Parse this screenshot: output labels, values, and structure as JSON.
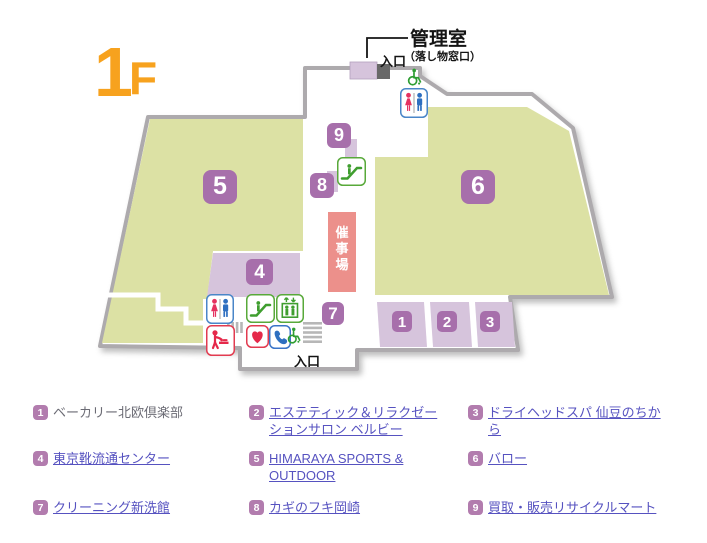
{
  "floor_label": {
    "number": "1",
    "suffix": "F"
  },
  "map": {
    "admin_room_label": "管理室",
    "admin_room_sub": "（落し物窓口）",
    "entrance_top": "入口",
    "entrance_bottom": "入口",
    "event_space": "催事場",
    "event_space_chars": [
      "催",
      "事",
      "場"
    ],
    "badges": {
      "b1": "1",
      "b2": "2",
      "b3": "3",
      "b4": "4",
      "b5": "5",
      "b6": "6",
      "b7": "7",
      "b8": "8",
      "b9": "9"
    },
    "icons": {
      "toilet": "toilet-icon",
      "wheelchair": "wheelchair-icon",
      "escalator": "escalator-icon",
      "elevator": "elevator-icon",
      "baby_care": "baby-care-icon",
      "aed_heart": "aed-heart-icon",
      "phone": "phone-icon",
      "stairs": "stairs-icon"
    }
  },
  "legend": {
    "items": [
      {
        "num": "1",
        "label": "ベーカリー北欧倶楽部",
        "link": false
      },
      {
        "num": "2",
        "label": "エステティック＆リラクゼーションサロン ベルビー",
        "link": true
      },
      {
        "num": "3",
        "label": "ドライヘッドスパ 仙豆のちから",
        "link": true
      },
      {
        "num": "4",
        "label": "東京靴流通センター",
        "link": true
      },
      {
        "num": "5",
        "label": "HIMARAYA SPORTS & OUTDOOR",
        "link": true
      },
      {
        "num": "6",
        "label": "バロー",
        "link": true
      },
      {
        "num": "7",
        "label": "クリーニング新洗館",
        "link": true
      },
      {
        "num": "8",
        "label": "カギのフキ岡崎",
        "link": true
      },
      {
        "num": "9",
        "label": "買取・販売リサイクルマート",
        "link": true
      }
    ]
  },
  "colors": {
    "floor_accent": "#f7a21e",
    "area_green": "#dce1a4",
    "area_lavender": "#d6c4dc",
    "badge_purple": "#a76fab",
    "legend_badge_purple": "#b27cae",
    "event_space_salmon": "#ec908b",
    "link_indigo": "#5652c0",
    "wall_gray": "#adaaad"
  }
}
